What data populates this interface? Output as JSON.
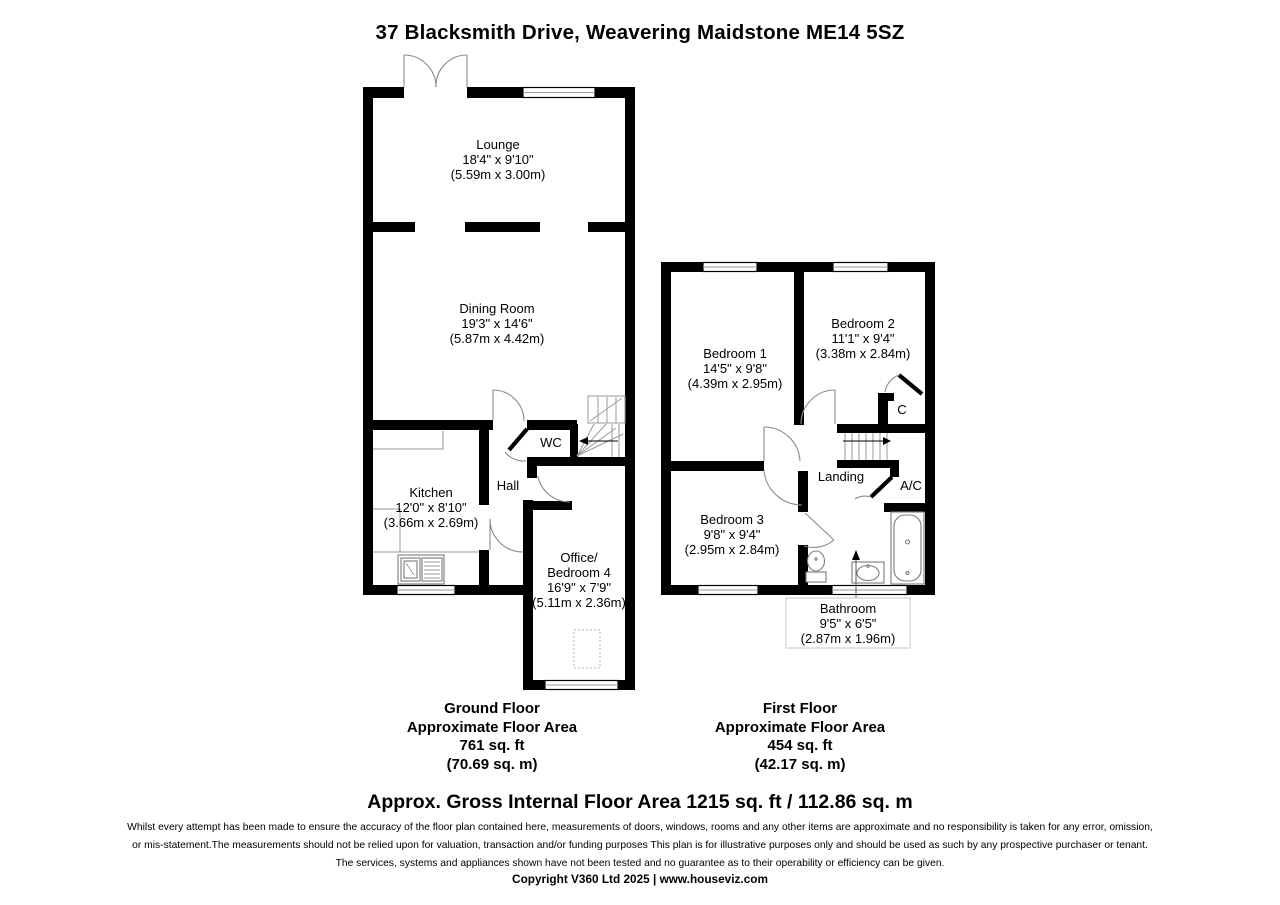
{
  "page": {
    "title": "37 Blacksmith Drive, Weavering Maidstone ME14 5SZ"
  },
  "ground_floor": {
    "rooms": {
      "lounge": {
        "name": "Lounge",
        "imperial": "18'4\" x 9'10\"",
        "metric": "(5.59m x 3.00m)"
      },
      "dining": {
        "name": "Dining Room",
        "imperial": "19'3\" x 14'6\"",
        "metric": "(5.87m x 4.42m)"
      },
      "kitchen": {
        "name": "Kitchen",
        "imperial": "12'0\" x 8'10\"",
        "metric": "(3.66m x 2.69m)"
      },
      "hall": {
        "name": "Hall"
      },
      "wc": {
        "name": "WC"
      },
      "office": {
        "name1": "Office/",
        "name2": "Bedroom 4",
        "imperial": "16'9\" x 7'9\"",
        "metric": "(5.11m x 2.36m)"
      }
    },
    "area_label": {
      "floor": "Ground Floor",
      "approx": "Approximate Floor Area",
      "sqft": "761 sq. ft",
      "sqm": "(70.69 sq. m)"
    }
  },
  "first_floor": {
    "rooms": {
      "bedroom1": {
        "name": "Bedroom 1",
        "imperial": "14'5\" x 9'8\"",
        "metric": "(4.39m x 2.95m)"
      },
      "bedroom2": {
        "name": "Bedroom 2",
        "imperial": "11'1\" x 9'4\"",
        "metric": "(3.38m x 2.84m)"
      },
      "bedroom3": {
        "name": "Bedroom 3",
        "imperial": "9'8\" x 9'4\"",
        "metric": "(2.95m x 2.84m)"
      },
      "bathroom": {
        "name": "Bathroom",
        "imperial": "9'5\" x 6'5\"",
        "metric": "(2.87m x 1.96m)"
      },
      "landing": {
        "name": "Landing"
      },
      "cupboard": {
        "name": "C"
      },
      "airing_cupboard": {
        "name": "A/C"
      }
    },
    "area_label": {
      "floor": "First Floor",
      "approx": "Approximate Floor Area",
      "sqft": "454 sq. ft",
      "sqm": "(42.17 sq. m)"
    }
  },
  "footer": {
    "gross_area": "Approx. Gross Internal Floor Area 1215 sq. ft / 112.86 sq. m",
    "disclaimer_line1": "Whilst every attempt has been made to ensure the accuracy of the floor plan contained here, measurements of doors, windows, rooms and any other items are approximate and no responsibility is taken for any error, omission,",
    "disclaimer_line2": "or mis-statement.The measurements should not be relied upon for valuation, transaction and/or funding purposes This plan is for illustrative purposes only and should be used as such by any prospective purchaser or tenant.",
    "disclaimer_line3": "The services, systems and appliances shown have not been tested and no guarantee as to their operability or efficiency can be given.",
    "copyright": "Copyright V360 Ltd 2025 | www.houseviz.com"
  },
  "colors": {
    "wall": "#000000",
    "detail_line": "#8a8a8a",
    "label_box_border": "#c8c8c8"
  }
}
